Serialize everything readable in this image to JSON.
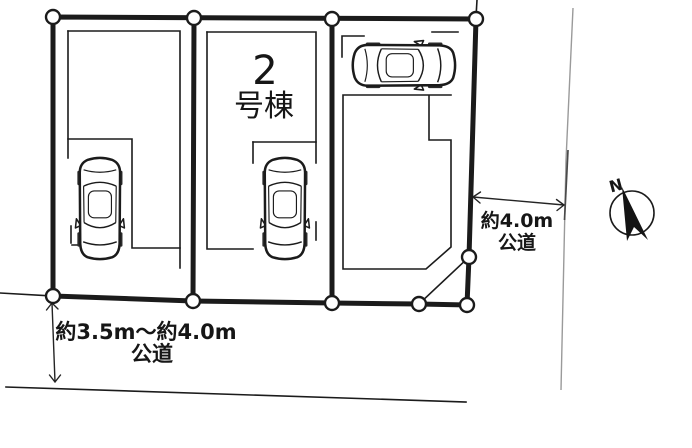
{
  "site_plan": {
    "building": {
      "number": "2",
      "suffix": "号棟"
    },
    "roads": {
      "south": {
        "width": "約3.5m〜約4.0m",
        "kind": "公道"
      },
      "east": {
        "width": "約4.0m",
        "kind": "公道"
      }
    },
    "compass": {
      "north": "N"
    },
    "lots": [
      {
        "id": "lot-1",
        "label": ""
      },
      {
        "id": "lot-2",
        "label": "2号棟"
      },
      {
        "id": "lot-3",
        "label": ""
      }
    ],
    "icons": {
      "cars": "car-top-view-icon",
      "compass": "north-arrow-icon",
      "boundary_points": "survey-point-circle"
    },
    "colors": {
      "background": "#ffffff",
      "line": "#1b1b1b",
      "faint_boundary": "#9a9a9a"
    }
  }
}
